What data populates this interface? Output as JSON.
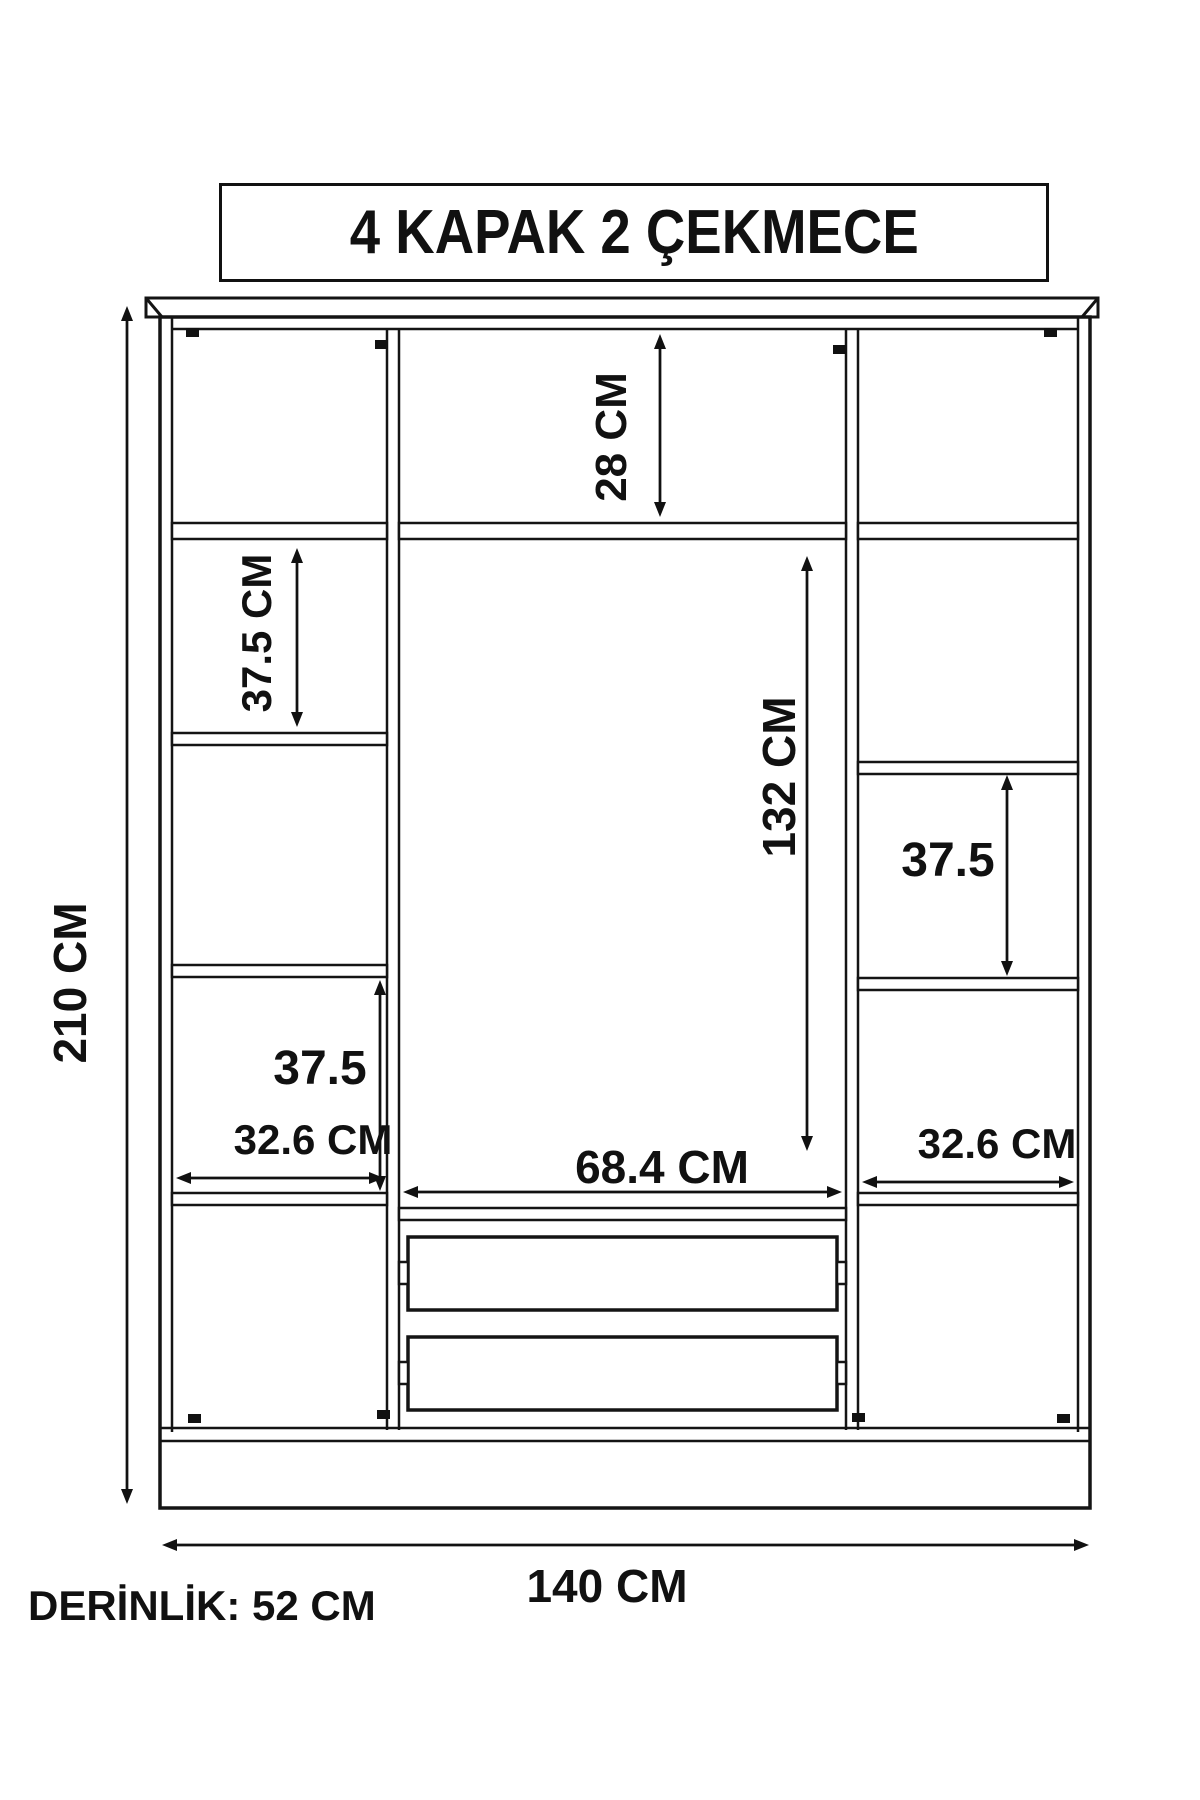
{
  "title": "4 KAPAK 2 ÇEKMECE",
  "depth_note": "DERİNLİK: 52 CM",
  "dimensions": {
    "overall_height": "210 CM",
    "overall_width": "140 CM",
    "top_section_height": "28 CM",
    "left_shelf_section_height": "37.5 CM",
    "middle_door_height": "132 CM",
    "right_shelf_section_height": "37.5",
    "left_lower_section_height": "37.5",
    "left_column_width": "32.6 CM",
    "middle_section_width": "68.4 CM",
    "right_column_width": "32.6 CM"
  }
}
